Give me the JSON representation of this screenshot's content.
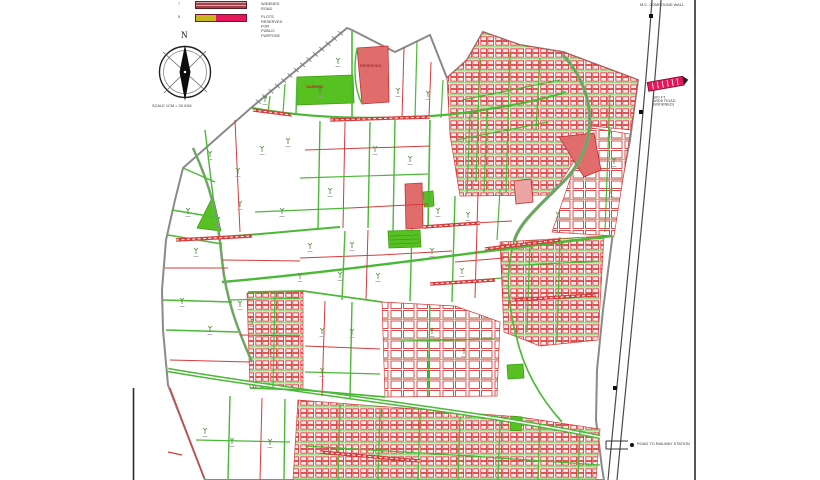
{
  "page": {
    "background": "#ffffff",
    "description": "Town planning scheme plot map"
  },
  "legend": {
    "items": [
      {
        "index": "7",
        "label": "WIDENED ROAD",
        "swatch": "hatched-maroon-bar"
      },
      {
        "index": "8",
        "label": "PLOTS RESERVED FOR PUBLIC PURPOSE",
        "swatch": "yellow-red-bar"
      }
    ]
  },
  "compass": {
    "north_letter": "N",
    "scale_text": "SCALE 1CM = 30.01M"
  },
  "annotations": {
    "top_right": "M.C. COMPOUND WALL",
    "widened_road_marker": {
      "line1": "100 FT.",
      "line2": "WIDE ROAD",
      "line3": "(WIDENED)"
    },
    "bottom_right": "ROAD TO RAILWAY STATION",
    "garden_plot": "GARDEN",
    "reserved_plot": "RESERVED"
  },
  "colors": {
    "plot_red": "#d63c3c",
    "road_green": "#4cb838",
    "fill_red": "#e06c6c",
    "fill_red_light": "#eba3a3",
    "fill_green": "#58c122",
    "boundary_gray": "#8a8a8a",
    "railway_dark": "#4a4a4a",
    "legend_maroon": "#a34248",
    "legend_yellow": "#c9b51d",
    "legend_crimson": "#e5175a"
  }
}
